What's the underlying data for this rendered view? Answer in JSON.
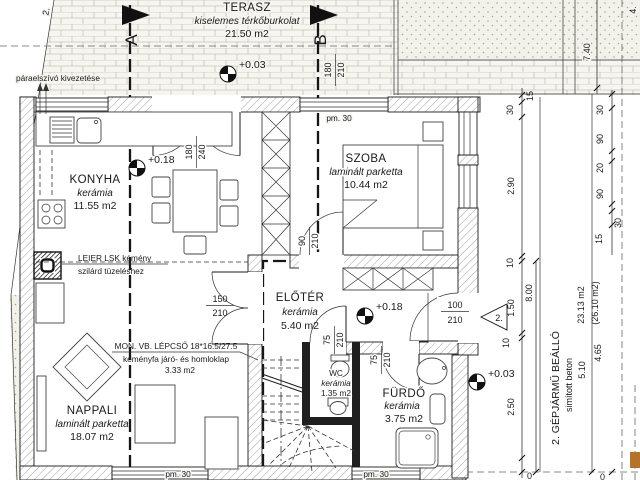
{
  "colors": {
    "paper": "#ffffff",
    "line": "#1a1a1a",
    "marker_orange": "#b5722a"
  },
  "section_markers": {
    "a": "A",
    "b": "B"
  },
  "rooms": {
    "terasz": {
      "name": "TERASZ",
      "finish": "kiselemes térkőburkolat",
      "area": "21.50 m2"
    },
    "konyha": {
      "name": "KONYHA",
      "finish": "kerámia",
      "area": "11.55 m2"
    },
    "szoba": {
      "name": "SZOBA",
      "finish": "laminált parketta",
      "area": "10.44 m2"
    },
    "eloter": {
      "name": "ELŐTÉR",
      "finish": "kerámia",
      "area": "5.40 m2"
    },
    "nappali": {
      "name": "NAPPALI",
      "finish": "laminált parketta",
      "area": "18.07 m2"
    },
    "wc": {
      "name": "WC",
      "finish": "kerámia",
      "area": "1.35 m2"
    },
    "furdo": {
      "name": "FÜRDŐ",
      "finish": "kerámia",
      "area": "3.75 m2"
    },
    "carport": {
      "name": "2. GÉPJÁRMŰ BEÁLLÓ",
      "finish": "simított beton",
      "area": "23.13 m2",
      "area_gross": "(26.10 m2)"
    }
  },
  "levels": {
    "terasz": "+0.03",
    "konyha": "+0.18",
    "eloter": "+0.18",
    "carport": "+0.03"
  },
  "annotations": {
    "paraelszivo": "páraelszívó kivezetése",
    "kemeny_line1": "LEIER LSK kémény",
    "kemeny_line2": "szilárd tüzeléshez",
    "lepcso_line1": "MON. VB. LÉPCSŐ 18*16.5/27.5",
    "lepcso_line2": "keményfa járó- és homloklap",
    "lepcso_area": "3.33 m2",
    "parapet": "pm. 30",
    "entry_number": "2."
  },
  "doors": {
    "terasz_double": {
      "w": "180",
      "h": "240"
    },
    "terasz_window": {
      "w": "180",
      "h": "210"
    },
    "szoba": {
      "w": "90",
      "h": "210"
    },
    "eloter": {
      "w": "150",
      "h": "210"
    },
    "entry": {
      "w": "100",
      "h": "210"
    },
    "wc": {
      "w": "75",
      "h": "210"
    },
    "furdo": {
      "w": "75",
      "h": "210"
    }
  },
  "dimensions": {
    "top_left_partial": "2.",
    "top_right_partial": "4.",
    "d740": "7.40",
    "d800": "8.00",
    "d510": "5.10",
    "d465": "4.65",
    "chain_a": [
      "15",
      "30",
      "2.90",
      "10",
      "1.50",
      "10",
      "2.50"
    ],
    "chain_b": [
      "30",
      "90",
      "20",
      "90",
      "15",
      "30"
    ],
    "bottom_partial_1": "0",
    "bottom_partial_2": "0"
  }
}
